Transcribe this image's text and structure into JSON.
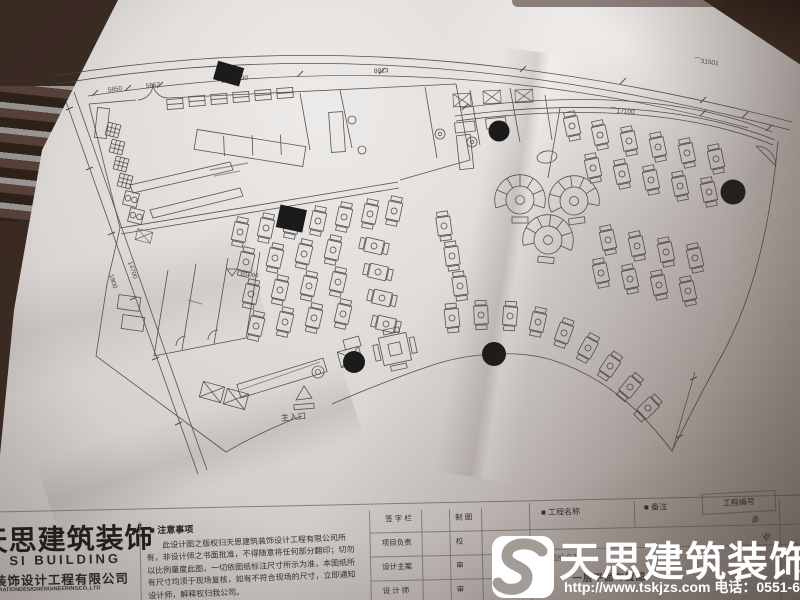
{
  "watermark": {
    "brand": "天思建筑装饰",
    "contact": "http://www.tskjzs.com 电话：0551-65568226",
    "logo_letter": "S"
  },
  "logo_block": {
    "brand_cn": "天思建筑装饰",
    "brand_en": "AN SI BUILDING",
    "company_cn": "筑装饰设计工程有限公司",
    "company_en": "DECORATIONDESIGNENGINEERINGCO.,LTD",
    "phone_fragment": "226"
  },
  "notes": {
    "header": "■ 注意事项",
    "body": "此设计图之版权归天思建筑装饰设计工程有限公司所有，非设计师之书面批准，不得随意将任何部分翻印；切勿以比例量度此图，一切依图纸标注尺寸所示为准，本图纸所有尺寸均须于现场复核，如有不符合现场的尺寸，立即通知设计师，解释权归我公司。"
  },
  "title_block": {
    "signature_column": "签 字 栏",
    "drafting": "制 图",
    "project_lead": "项目负责",
    "proofread": "校",
    "chief_designer": "设计主案",
    "approved": "审",
    "designer": "设 计 师",
    "reviewed": "审",
    "project_name": "■ 工程名称",
    "remarks": "■ 备注",
    "project_no": "工程编号",
    "specialty": "专 业",
    "drawing_name": "■ 图纸名称",
    "drawing_title": "一层平面布置图"
  },
  "plan": {
    "entrance": "主入口",
    "level": "±0.000",
    "dims": {
      "d1": "5850",
      "d2": "5863",
      "d3": "8830",
      "d4": "8813",
      "arc_outer": "⌒31501",
      "arc_inner": "⌒17100",
      "left_a": "1800",
      "left_b": "14700"
    }
  },
  "colors": {
    "paper": "#d6d1ce",
    "ink": "#4a4643",
    "backdrop": "#3a2a22",
    "watermark": "#ffffff"
  }
}
